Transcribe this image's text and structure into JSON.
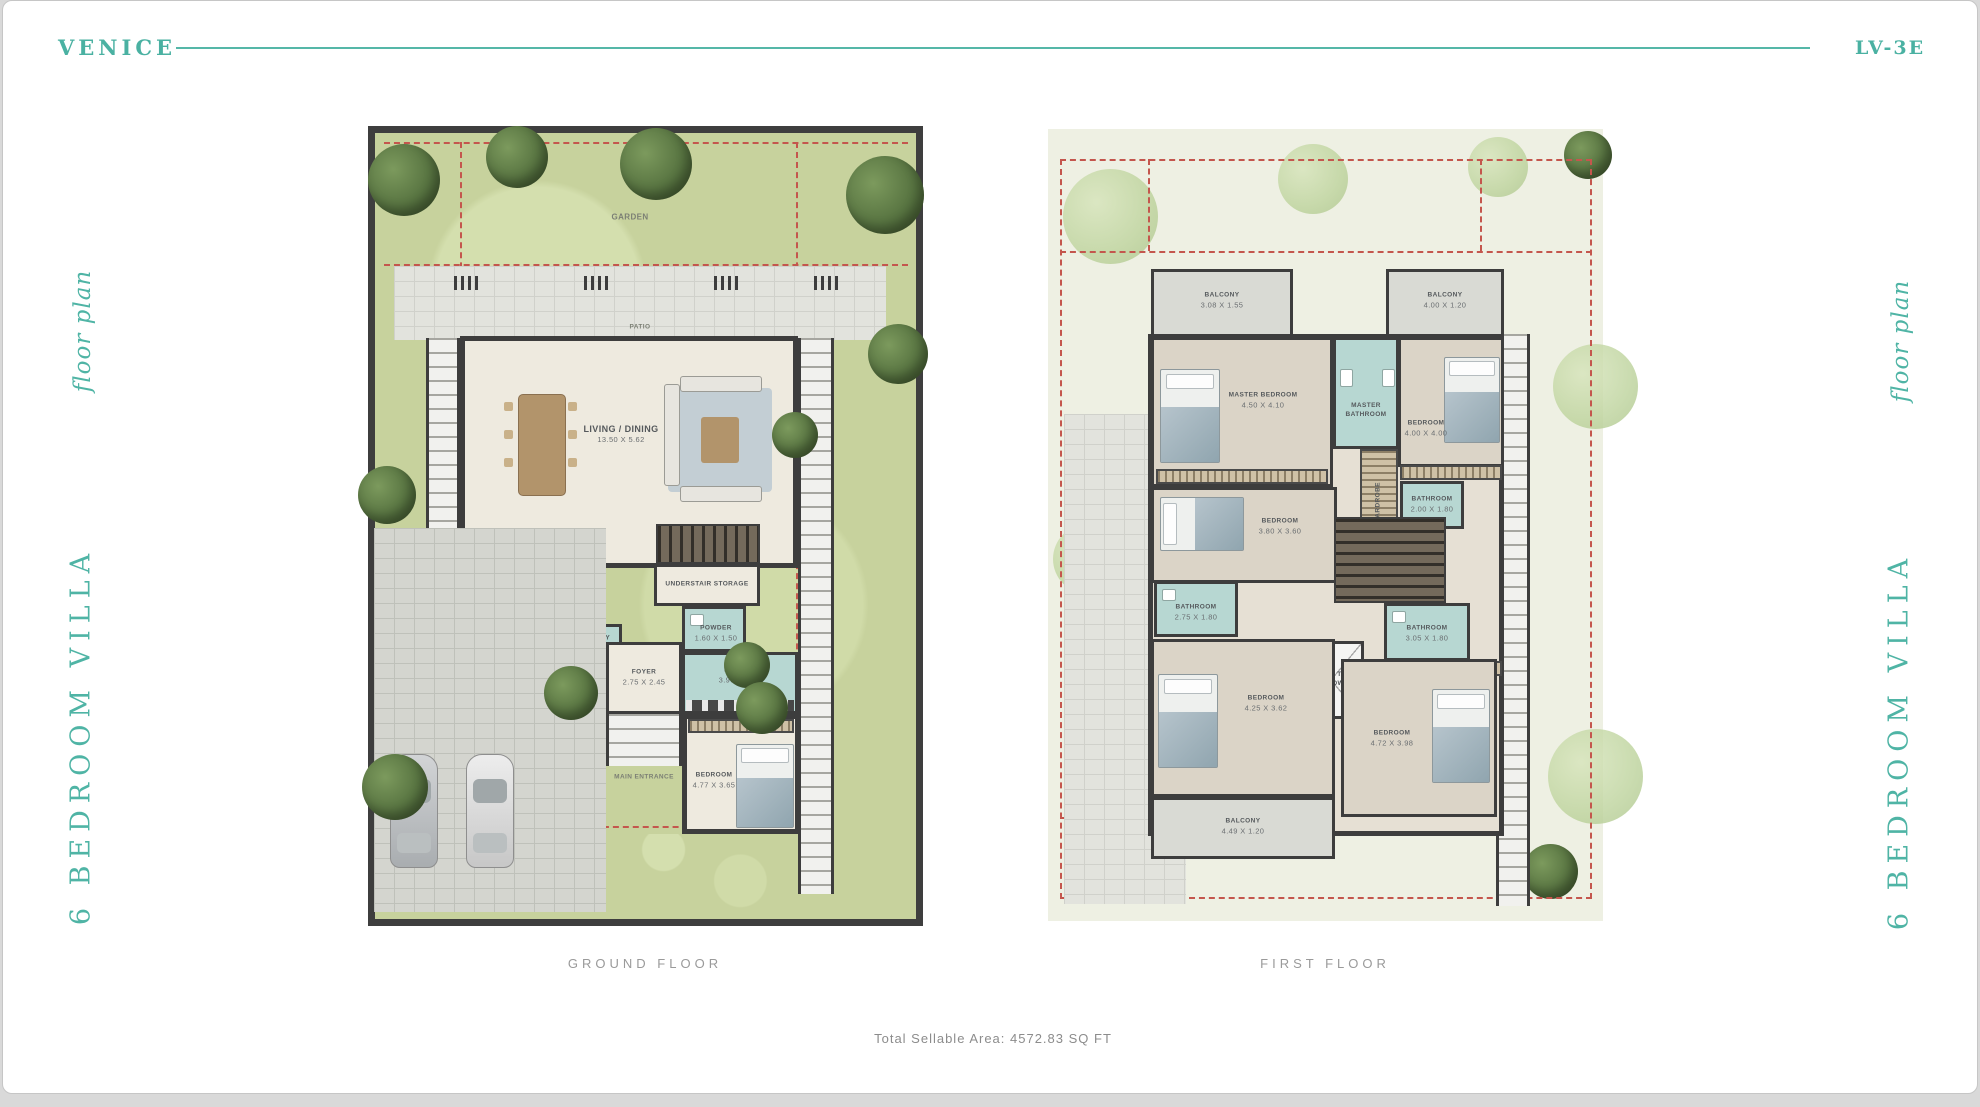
{
  "header": {
    "brand": "VENICE",
    "unit_code": "LV-3E"
  },
  "side_labels": {
    "floor_plan": "floor plan",
    "villa_type": "6 BEDROOM VILLA"
  },
  "colors": {
    "accent": "#4ab1a2",
    "setback_dashed": "#c4564d",
    "wall": "#3d3d3d",
    "garden": "#c7d29d",
    "bathroom": "#b7d7d2"
  },
  "ground": {
    "caption": "GROUND FLOOR",
    "rooms": {
      "garden": {
        "name": "GARDEN"
      },
      "patio": {
        "name": "PATIO"
      },
      "living": {
        "name": "LIVING / DINING",
        "dim": "13.50 X 5.62"
      },
      "laundry": {
        "name": "LAUNDRY",
        "dim": "2.20 X 2.00"
      },
      "maids": {
        "name": "MAID'S",
        "dim": "2.50 X 2.96"
      },
      "wc": {
        "name": "W.C."
      },
      "storage": {
        "name": "UNDERSTAIR STORAGE"
      },
      "powder": {
        "name": "POWDER",
        "dim": "1.60 X 1.50"
      },
      "kitchen": {
        "name": "KITCHEN",
        "dim": "3.90 X 3.45"
      },
      "foyer": {
        "name": "FOYER",
        "dim": "2.75 X 2.45"
      },
      "entrance": {
        "name": "MAIN ENTRANCE"
      },
      "bedroom": {
        "name": "BEDROOM",
        "dim": "4.77 X 3.65"
      }
    }
  },
  "first": {
    "caption": "FIRST FLOOR",
    "rooms": {
      "balcony_tl": {
        "name": "BALCONY",
        "dim": "3.08 X 1.55"
      },
      "balcony_tr": {
        "name": "BALCONY",
        "dim": "4.00 X 1.20"
      },
      "master": {
        "name": "MASTER BEDROOM",
        "dim": "4.50 X 4.10"
      },
      "master_bath": {
        "name": "MASTER BATHROOM"
      },
      "wardrobe": {
        "name": "WARDROBE"
      },
      "bedroom2": {
        "name": "BEDROOM",
        "dim": "4.00 X 4.00"
      },
      "bath2": {
        "name": "BATHROOM",
        "dim": "2.00 X 1.80"
      },
      "bedroom3": {
        "name": "BEDROOM",
        "dim": "3.80 X 3.60"
      },
      "bath3": {
        "name": "BATHROOM",
        "dim": "2.75 X 1.80"
      },
      "bath4": {
        "name": "BATHROOM",
        "dim": "3.05 X 1.80"
      },
      "open_below": {
        "name": "OPEN TO BELOW"
      },
      "bedroom4": {
        "name": "BEDROOM",
        "dim": "4.25 X 3.62"
      },
      "bedroom5": {
        "name": "BEDROOM",
        "dim": "4.72 X 3.98"
      },
      "balcony_b": {
        "name": "BALCONY",
        "dim": "4.49 X 1.20"
      }
    }
  },
  "footer": {
    "total_area": "Total Sellable Area: 4572.83 SQ FT"
  }
}
